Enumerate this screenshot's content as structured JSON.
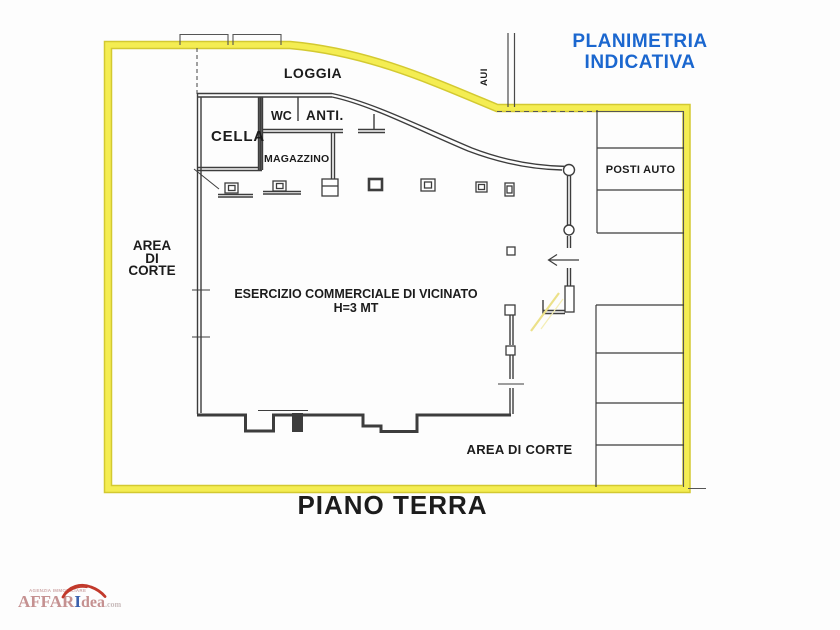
{
  "header": {
    "title_line1": "PLANIMETRIA",
    "title_line2": "INDICATIVA"
  },
  "plan": {
    "floor_title": "PIANO TERRA",
    "labels": {
      "loggia": "LOGGIA",
      "aui": "AUI",
      "cella": "CELLA",
      "wc": "WC",
      "anti": "ANTI.",
      "magazzino": "MAGAZZINO",
      "area_corte_left_line1": "AREA",
      "area_corte_left_line2": "DI",
      "area_corte_left_line3": "CORTE",
      "esercizio": "ESERCIZIO COMMERCIALE DI VICINATO",
      "altezza": "H=3 MT",
      "posti_auto": "POSTI AUTO",
      "area_corte_bottom": "AREA DI CORTE"
    }
  },
  "watermark": {
    "tagline": "AGENZIA IMMOBILIARE",
    "brand_part1": "AFFAR",
    "brand_part2": "I",
    "brand_part3": "dea",
    "brand_tld": ".com"
  },
  "colors": {
    "boundary_yellow": "#f4ed52",
    "boundary_yellow_edge": "#d3c931",
    "title_blue": "#1b67cf",
    "wall_black": "#3d3d3d",
    "door_highlight": "#ece189",
    "brand_rose": "#c59191",
    "brand_blue": "#3b61ad",
    "swoosh_red": "#c2392b"
  }
}
